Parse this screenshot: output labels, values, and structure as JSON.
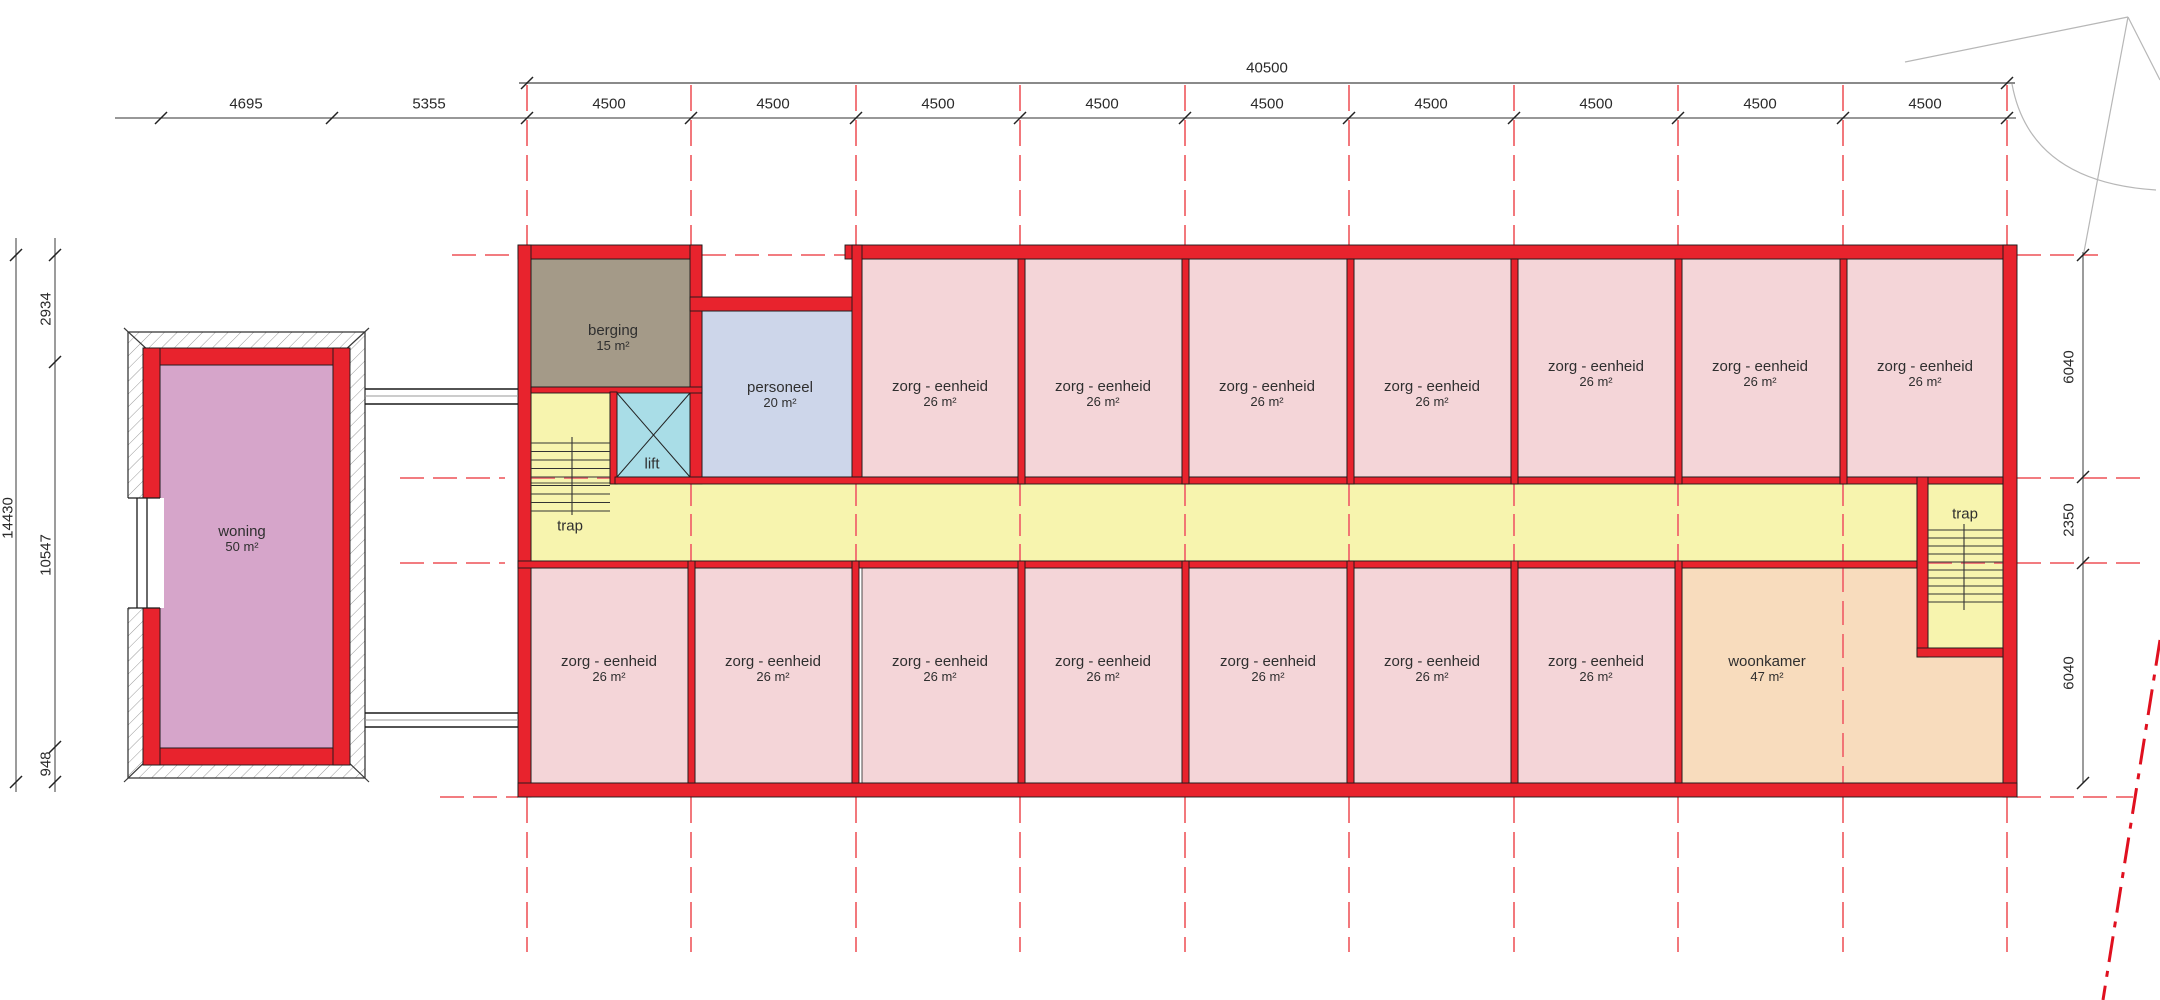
{
  "title": "floor plan - zorg eenheden verdieping",
  "colors": {
    "wall": "#e8232d",
    "outline": "#1a1a1a",
    "grid": "#f0696e",
    "diagonal": "#e0101f",
    "construction": "#b7b7b7",
    "dimline": "#5a5a5a",
    "dimline_heavy": "#8a8a8a",
    "zorg": "#f4d5d8",
    "corridor": "#f7f4ae",
    "lift": "#a9dde7",
    "personeel": "#cdd6ea",
    "berging": "#a49a88",
    "woning": "#d6a5ca",
    "woonkamer": "#f8dcbd"
  },
  "labels": {
    "woning_name": "woning",
    "woning_area": "50 m²",
    "berging_name": "berging",
    "berging_area": "15 m²",
    "personeel_name": "personeel",
    "personeel_area": "20 m²",
    "lift_name": "lift",
    "trap_left_name": "trap",
    "trap_right_name": "trap",
    "zorg_name": "zorg - eenheid",
    "zorg_area": "26 m²",
    "woonkamer_name": "woonkamer",
    "woonkamer_area": "47 m²"
  },
  "dims": {
    "total_top": "40500",
    "d4695": "4695",
    "d5355": "5355",
    "d4500": "4500",
    "d14430": "14430",
    "d2934": "2934",
    "d10547": "10547",
    "d948": "948",
    "d6040_top": "6040",
    "d2350": "2350",
    "d6040_bottom": "6040"
  },
  "plan": {
    "fills": [
      {
        "name": "woning",
        "color": "woning",
        "x": 160,
        "y": 365,
        "w": 173,
        "h": 383
      },
      {
        "name": "berging",
        "color": "berging",
        "x": 531,
        "y": 259,
        "w": 171,
        "h": 128
      },
      {
        "name": "personeel",
        "color": "personeel",
        "x": 702,
        "y": 311,
        "w": 150,
        "h": 166
      },
      {
        "name": "lift",
        "color": "lift",
        "x": 617,
        "y": 393,
        "w": 73,
        "h": 84
      },
      {
        "name": "trap-left",
        "color": "corridor",
        "x": 531,
        "y": 392,
        "w": 79,
        "h": 169
      },
      {
        "name": "corridor",
        "color": "corridor",
        "x": 531,
        "y": 483,
        "w": 1386,
        "h": 78
      },
      {
        "name": "zorg-top-1",
        "color": "zorg",
        "x": 862,
        "y": 259,
        "w": 156,
        "h": 218
      },
      {
        "name": "zorg-top-2",
        "color": "zorg",
        "x": 1025,
        "y": 259,
        "w": 157,
        "h": 218
      },
      {
        "name": "zorg-top-3",
        "color": "zorg",
        "x": 1189,
        "y": 259,
        "w": 158,
        "h": 218
      },
      {
        "name": "zorg-top-4",
        "color": "zorg",
        "x": 1354,
        "y": 259,
        "w": 157,
        "h": 218
      },
      {
        "name": "zorg-top-5",
        "color": "zorg",
        "x": 1518,
        "y": 259,
        "w": 157,
        "h": 218
      },
      {
        "name": "zorg-top-6",
        "color": "zorg",
        "x": 1682,
        "y": 259,
        "w": 158,
        "h": 218
      },
      {
        "name": "zorg-top-7",
        "color": "zorg",
        "x": 1847,
        "y": 259,
        "w": 156,
        "h": 218
      },
      {
        "name": "zorg-bottom-1",
        "color": "zorg",
        "x": 531,
        "y": 568,
        "w": 157,
        "h": 215
      },
      {
        "name": "zorg-bottom-2",
        "color": "zorg",
        "x": 695,
        "y": 568,
        "w": 157,
        "h": 215
      },
      {
        "name": "zorg-bottom-3",
        "color": "zorg",
        "x": 862,
        "y": 568,
        "w": 156,
        "h": 215
      },
      {
        "name": "zorg-bottom-4",
        "color": "zorg",
        "x": 1025,
        "y": 568,
        "w": 157,
        "h": 215
      },
      {
        "name": "zorg-bottom-5",
        "color": "zorg",
        "x": 1189,
        "y": 568,
        "w": 158,
        "h": 215
      },
      {
        "name": "zorg-bottom-6",
        "color": "zorg",
        "x": 1354,
        "y": 568,
        "w": 157,
        "h": 215
      },
      {
        "name": "zorg-bottom-7",
        "color": "zorg",
        "x": 1518,
        "y": 568,
        "w": 157,
        "h": 215
      },
      {
        "name": "woonkamer",
        "color": "woonkamer",
        "x": 1682,
        "y": 568,
        "w": 321,
        "h": 215
      },
      {
        "name": "trap-right",
        "color": "corridor",
        "x": 1928,
        "y": 484,
        "w": 75,
        "h": 164
      }
    ],
    "walls": [
      [
        518,
        245,
        184,
        14
      ],
      [
        690,
        245,
        12,
        239
      ],
      [
        690,
        297,
        172,
        14
      ],
      [
        845,
        245,
        1172,
        14
      ],
      [
        852,
        245,
        10,
        232
      ],
      [
        518,
        245,
        13,
        552
      ],
      [
        2003,
        245,
        14,
        552
      ],
      [
        518,
        783,
        1499,
        14
      ],
      [
        531,
        387,
        171,
        6
      ],
      [
        610,
        392,
        7,
        92
      ],
      [
        615,
        477,
        1388,
        7
      ],
      [
        518,
        561,
        1399,
        7
      ],
      [
        1917,
        477,
        11,
        180
      ],
      [
        1917,
        648,
        86,
        9
      ],
      [
        1018,
        259,
        7,
        225
      ],
      [
        1182,
        259,
        7,
        225
      ],
      [
        1347,
        259,
        7,
        225
      ],
      [
        1511,
        259,
        7,
        225
      ],
      [
        1675,
        259,
        7,
        225
      ],
      [
        1840,
        259,
        7,
        225
      ],
      [
        688,
        561,
        7,
        222
      ],
      [
        852,
        561,
        7,
        222
      ],
      [
        1018,
        561,
        7,
        222
      ],
      [
        1182,
        561,
        7,
        222
      ],
      [
        1347,
        561,
        7,
        222
      ],
      [
        1511,
        561,
        7,
        222
      ],
      [
        1675,
        561,
        7,
        222
      ],
      [
        143,
        348,
        207,
        17
      ],
      [
        143,
        748,
        207,
        17
      ],
      [
        143,
        348,
        17,
        152
      ],
      [
        143,
        607,
        17,
        158
      ],
      [
        333,
        348,
        17,
        417
      ]
    ],
    "grid_x": [
      527,
      691,
      856,
      1020,
      1185,
      1349,
      1514,
      1678,
      1843,
      2007
    ],
    "vgrid": {
      "above": [
        85,
        245
      ],
      "corridor": [
        484,
        561
      ],
      "below": [
        797,
        952
      ],
      "corridor_idx": [
        1,
        2,
        3,
        4,
        5,
        6,
        7,
        8
      ],
      "extra": [
        {
          "x": 1843,
          "y1": 568,
          "y2": 783
        }
      ]
    },
    "hgrid": [
      {
        "y": 255,
        "segs": [
          [
            452,
            518
          ],
          [
            702,
            845
          ],
          [
            2017,
            2098
          ]
        ]
      },
      {
        "y": 478,
        "segs": [
          [
            400,
            505
          ],
          [
            531,
            613
          ],
          [
            2017,
            2146
          ]
        ]
      },
      {
        "y": 563,
        "segs": [
          [
            400,
            505
          ],
          [
            1928,
            2003
          ],
          [
            2017,
            2146
          ]
        ]
      },
      {
        "y": 797,
        "segs": [
          [
            440,
            518
          ],
          [
            2017,
            2133
          ]
        ]
      }
    ],
    "dimlines": [
      {
        "x1": 519,
        "y1": 83,
        "x2": 2015,
        "y2": 83,
        "w": 2,
        "heavy": true
      },
      {
        "x1": 115,
        "y1": 118,
        "x2": 2016,
        "y2": 118
      },
      {
        "x1": 16,
        "y1": 238,
        "x2": 16,
        "y2": 792
      },
      {
        "x1": 55,
        "y1": 238,
        "x2": 55,
        "y2": 792
      },
      {
        "x1": 2083,
        "y1": 252,
        "x2": 2083,
        "y2": 783
      }
    ],
    "ticks": [
      [
        527,
        83
      ],
      [
        2007,
        83
      ],
      [
        161,
        118
      ],
      [
        332,
        118
      ],
      [
        527,
        118
      ],
      [
        691,
        118
      ],
      [
        856,
        118
      ],
      [
        1020,
        118
      ],
      [
        1185,
        118
      ],
      [
        1349,
        118
      ],
      [
        1514,
        118
      ],
      [
        1678,
        118
      ],
      [
        1843,
        118
      ],
      [
        2007,
        118
      ],
      [
        16,
        255
      ],
      [
        16,
        782
      ],
      [
        55,
        255
      ],
      [
        55,
        362
      ],
      [
        55,
        747
      ],
      [
        55,
        782
      ],
      [
        2083,
        255
      ],
      [
        2083,
        477
      ],
      [
        2083,
        563
      ],
      [
        2083,
        783
      ]
    ],
    "stairs": [
      {
        "x1": 531,
        "x2": 610,
        "y0": 443,
        "dy": 8.5,
        "n": 9,
        "sx": 572,
        "sy1": 437,
        "sy2": 515
      },
      {
        "x1": 1928,
        "x2": 2003,
        "y0": 530,
        "dy": 8,
        "n": 10,
        "sx": 1964,
        "sy1": 524,
        "sy2": 610
      }
    ],
    "bridges": {
      "black_y": [
        389,
        404,
        713,
        727
      ],
      "gray_y": [
        396,
        720
      ],
      "x1": 365,
      "x2": 518
    },
    "lift_x_box": [
      617,
      393,
      690,
      477
    ],
    "construction": {
      "lines": [
        [
          1905,
          62,
          2128,
          17
        ],
        [
          2128,
          17,
          2084,
          252
        ],
        [
          2128,
          17,
          2160,
          80
        ]
      ],
      "arc": "M 2012,84 Q 2030,182 2156,190"
    },
    "diagonal": [
      2160,
      640,
      2103,
      1000
    ],
    "woning_deco": {
      "outer": [
        128,
        332,
        237,
        446
      ],
      "corners": [
        [
          124,
          328,
          150,
          352
        ],
        [
          369,
          328,
          343,
          352
        ],
        [
          124,
          782,
          150,
          757
        ],
        [
          369,
          782,
          343,
          757
        ]
      ],
      "opening": {
        "rect": [
          126,
          498,
          38,
          110
        ],
        "lines_x": [
          137,
          147
        ],
        "y1": 498,
        "y2": 608,
        "cap_x": [
          128,
          160
        ]
      }
    }
  }
}
